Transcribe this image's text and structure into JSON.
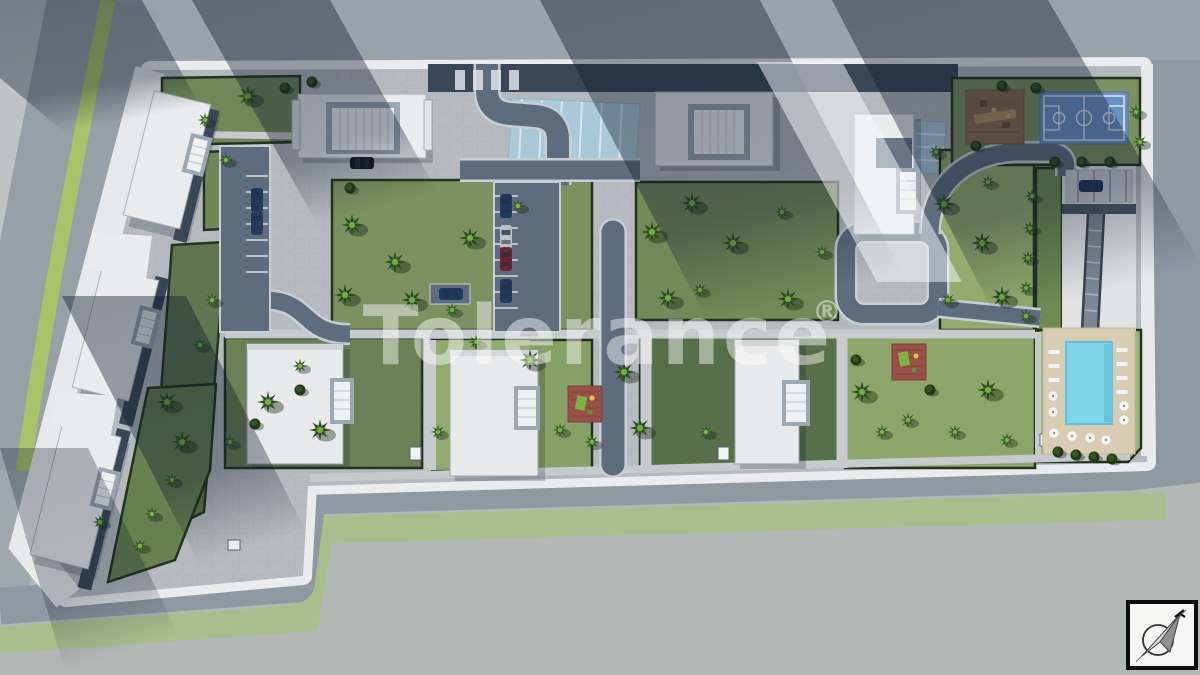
{
  "watermark": {
    "text": "Tolerance",
    "registered_mark": "®",
    "color": "#ffffff",
    "opacity": 0.45
  },
  "icons": {
    "compass": "compass-north-arrow-icon"
  },
  "scene": {
    "type": "aerial-3d-site-plan-render",
    "amenities": [
      "swimming-pool",
      "basketball-court",
      "children-playground",
      "small-playgrounds",
      "parking-areas",
      "landscaped-gardens",
      "underground-parking-ramp"
    ]
  },
  "colors": {
    "road_outer": "#8e99a2",
    "road_inner": "#5e6d7d",
    "curb": "#c9ced4",
    "plaza": "#b6babe",
    "pavement_bottom": "#b2b8b6",
    "sidewalk_white": "#e8eaeb",
    "grass_strip": "#a9be8d",
    "lawn": "#7c9160",
    "lawn_bright": "#93ac6e",
    "lawn_dark": "#5e7550",
    "hedge": "#24331f",
    "tree_bright": "#6ca83e",
    "building_white": "#eaebec",
    "roof_gray": "#9da7b1",
    "roof_dark": "#3a4757",
    "glass_blue": "#a9c9d9",
    "pool_water": "#7ed5e8",
    "pool_deck": "#d8ccb2",
    "court_blue": "#6b90c7",
    "sand": "#8a6a50",
    "playground_red": "#99504a",
    "median_green": "#a8c368",
    "shadow": "rgba(15,27,45,0.40)"
  }
}
